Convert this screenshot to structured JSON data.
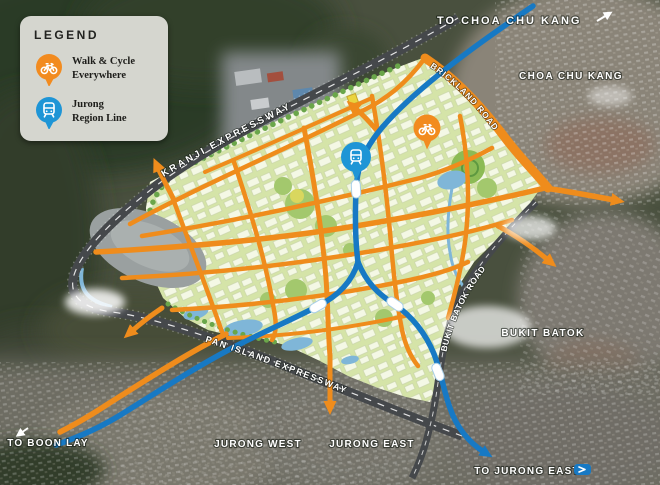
{
  "legend": {
    "title": "LEGEND",
    "items": [
      {
        "label": "Walk & Cycle Everywhere",
        "line1": "Walk & Cycle",
        "line2": "Everywhere",
        "icon": "bicycle-icon",
        "color": "#F28B1F"
      },
      {
        "label": "Jurong Region Line",
        "line1": "Jurong",
        "line2": "Region Line",
        "icon": "train-icon",
        "color": "#1E95D6"
      }
    ]
  },
  "map": {
    "direction_labels": {
      "to_choa_chu_kang": "TO CHOA CHU KANG",
      "to_boon_lay": "TO BOON LAY",
      "to_jurong_east": "TO JURONG EAST"
    },
    "place_labels": {
      "choa_chu_kang": "CHOA CHU KANG",
      "bukit_batok": "BUKIT BATOK",
      "jurong_west": "JURONG WEST",
      "jurong_east": "JURONG EAST"
    },
    "road_labels": {
      "kranji_expressway": "KRANJI EXPRESSWAY",
      "brickland_road": "BRICKLAND ROAD",
      "pan_island_expressway": "PAN ISLAND EXPRESSWAY",
      "bukit_batok_road": "BUKIT BATOK ROAD"
    },
    "markers": [
      {
        "name": "walk-cycle-marker",
        "icon": "bicycle-icon",
        "color": "#F28B1F"
      },
      {
        "name": "jurong-region-line-marker",
        "icon": "train-icon",
        "color": "#1E95D6"
      }
    ],
    "station_count": 4,
    "colors": {
      "planned_town": "#D5E4A8",
      "orange_road": "#EF8C1C",
      "rail_line": "#1779C4",
      "expressway_road": "#45484B",
      "water": "#7FB6D8",
      "station": "#FFFFFF",
      "industrial_gray": "#9AA0A0"
    }
  }
}
